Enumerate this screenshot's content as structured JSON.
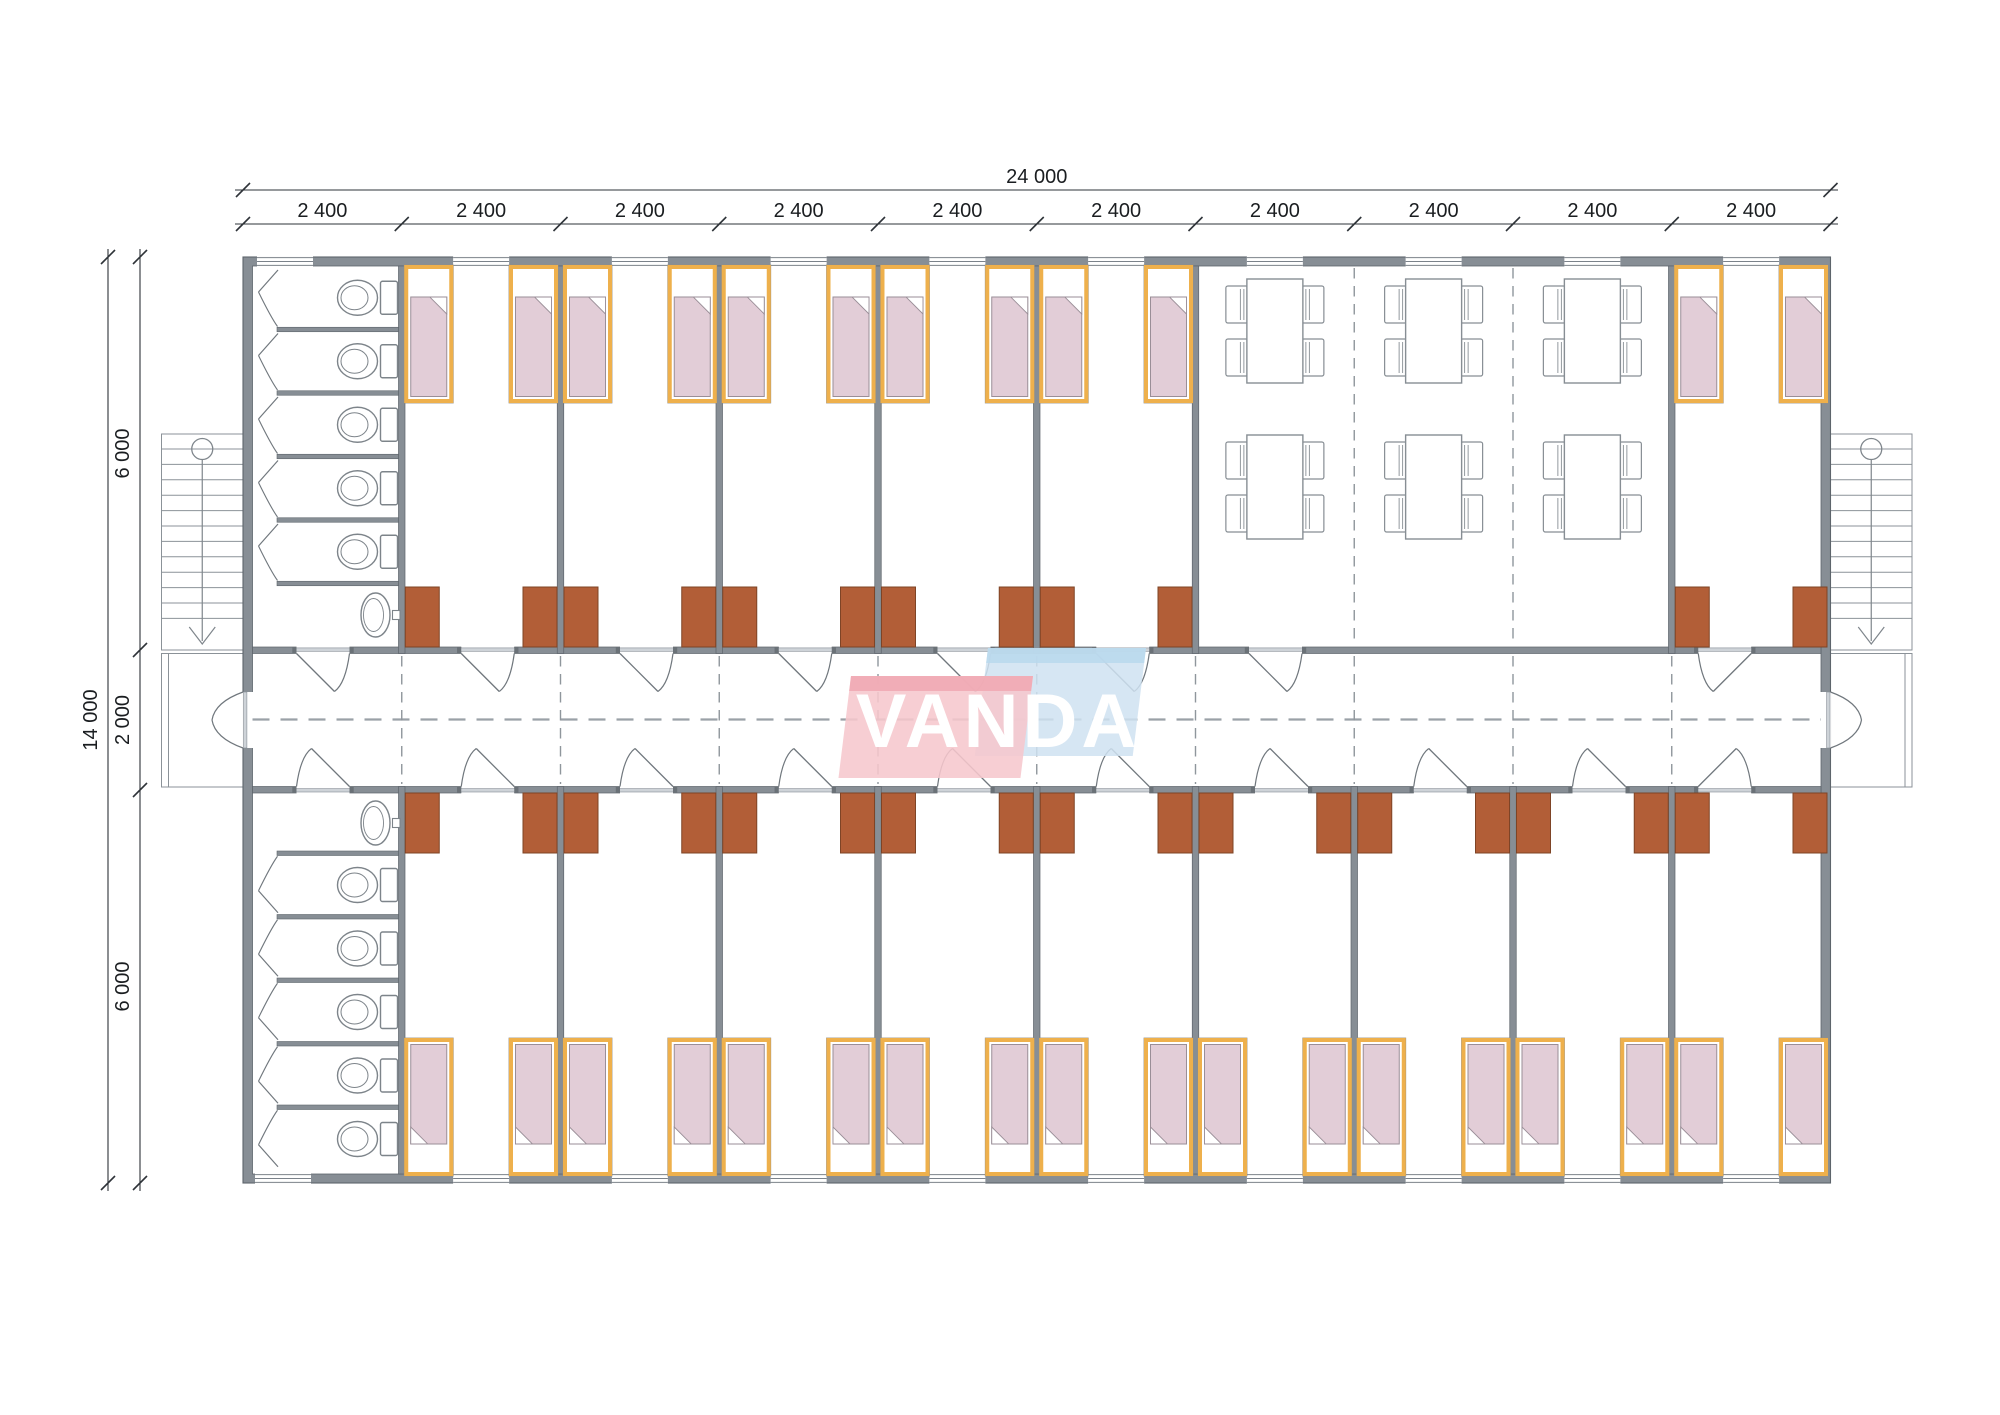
{
  "drawing": {
    "logo": {
      "text": "VANDA"
    },
    "dimensions": {
      "total_width_label": "24 000",
      "module_labels": [
        "2 400",
        "2 400",
        "2 400",
        "2 400",
        "2 400",
        "2 400",
        "2 400",
        "2 400",
        "2 400",
        "2 400"
      ],
      "total_height_label": "14 000",
      "height_segment_labels": [
        "6 000",
        "2 000",
        "6 000"
      ]
    },
    "structure": {
      "modules": 10,
      "top_band": {
        "bathroom_modules": [
          1
        ],
        "bedroom_modules": [
          2,
          3,
          4,
          5,
          6,
          10
        ],
        "dining_modules": [
          7,
          8,
          9
        ]
      },
      "bottom_band": {
        "bathroom_modules": [
          1
        ],
        "bedroom_modules": [
          2,
          3,
          4,
          5,
          6,
          7,
          8,
          9,
          10
        ]
      },
      "beds_per_room": 2,
      "wardrobes_per_room": 2,
      "toilet_stalls_per_bathroom": 5,
      "sinks_per_bathroom": 1,
      "dining_tables": 6,
      "chairs_per_table": 4,
      "staircases": 2
    },
    "colors": {
      "wall": "#878e95",
      "wall_stroke": "#5d646b",
      "line": "#70777d",
      "dash": "#8f969c",
      "center_dash": "#9aa1a7",
      "dim": "#2e3338",
      "dim_text": "#17191b",
      "threshold": "#ced3d8",
      "bed_frame": "#eeb04c",
      "bed_outline": "#958f84",
      "blanket": "#e2cdd7",
      "blanket_stroke": "#9a8e97",
      "wardrobe": "#b25e37",
      "wardrobe_stroke": "#7e4426",
      "fixture": "#7d848a",
      "furniture": "#878e94",
      "logo_pink": "#f6c7cd",
      "logo_pink_dark": "#f0a9b3",
      "logo_blue": "#cfe2f1",
      "logo_blue_dark": "#b9d8ec",
      "logo_text": "#ffffff"
    }
  }
}
